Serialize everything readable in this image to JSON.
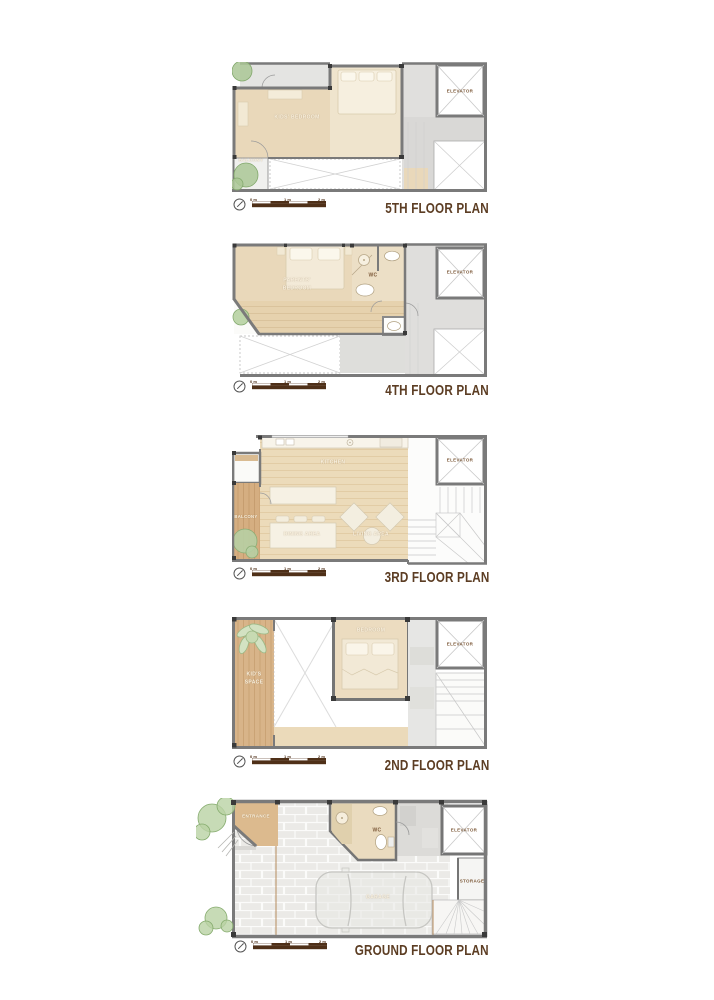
{
  "floors": [
    {
      "title": "5TH FLOOR PLAN",
      "rooms": {
        "kids_bedroom": "KIDS' BEDROOM",
        "balcony": "BALCONY",
        "elevator": "ELEVATOR"
      }
    },
    {
      "title": "4TH FLOOR PLAN",
      "rooms": {
        "parents_bedroom_line1": "PARENTS'",
        "parents_bedroom_line2": "BEDROOM",
        "wc": "WC",
        "elevator": "ELEVATOR"
      }
    },
    {
      "title": "3RD FLOOR PLAN",
      "rooms": {
        "kitchen": "KITCHEN",
        "balcony": "BALCONY",
        "dining": "DINING AREA",
        "living": "LIVING AREA",
        "elevator": "ELEVATOR"
      }
    },
    {
      "title": "2ND FLOOR PLAN",
      "rooms": {
        "kids_space_line1": "KID'S",
        "kids_space_line2": "SPACE",
        "bedroom": "BEDROOM",
        "elevator": "ELEVATOR"
      }
    },
    {
      "title": "GROUND FLOOR PLAN",
      "rooms": {
        "entrance": "ENTRANCE",
        "wc": "WC",
        "elevator": "ELEVATOR",
        "storage": "STORAGE",
        "garage": "GARAGE"
      }
    }
  ],
  "scalebar": {
    "labels": [
      "0 m",
      "1 m",
      "2 m"
    ]
  },
  "colors": {
    "title_brown": "#5c3d23",
    "label_cream": "#fbf3e1",
    "label_brown": "#7d5a3a",
    "wall_gray": "#7a7a7a",
    "floor_beige": "#e9d8ba",
    "wood_tan": "#d7b289",
    "tree_green": "#a9c594",
    "scalebar_brown": "#4f3018"
  }
}
